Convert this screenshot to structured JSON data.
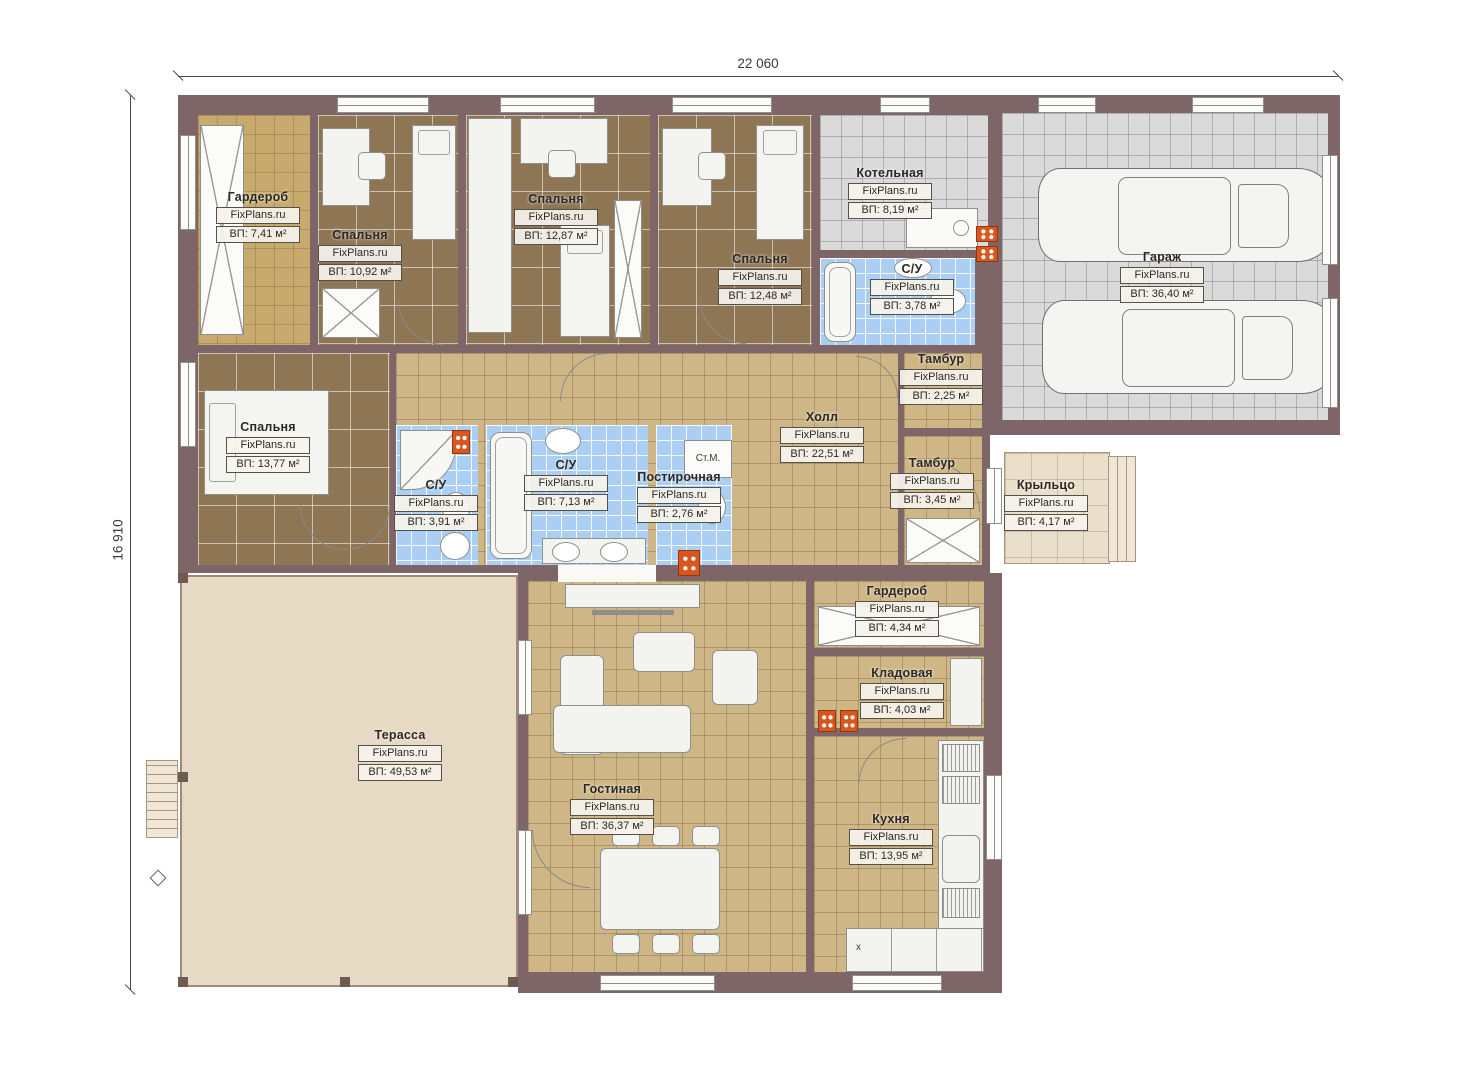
{
  "plan": {
    "width_label": "22 060",
    "height_label": "16 910"
  },
  "watermark": "FixPlans.ru",
  "rooms": [
    {
      "name": "Гардероб",
      "area": "ВП: 7,41 м²"
    },
    {
      "name": "Спальня",
      "area": "ВП: 10,92 м²"
    },
    {
      "name": "Спальня",
      "area": "ВП: 12,87 м²"
    },
    {
      "name": "Спальня",
      "area": "ВП: 12,48 м²"
    },
    {
      "name": "Котельная",
      "area": "ВП: 8,19 м²"
    },
    {
      "name": "Гараж",
      "area": "ВП: 36,40 м²"
    },
    {
      "name": "С/У",
      "area": "ВП: 3,78 м²"
    },
    {
      "name": "Тамбур",
      "area": "ВП: 2,25 м²"
    },
    {
      "name": "Холл",
      "area": "ВП: 22,51 м²"
    },
    {
      "name": "Спальня",
      "area": "ВП: 13,77 м²"
    },
    {
      "name": "С/У",
      "area": "ВП: 3,91 м²"
    },
    {
      "name": "С/У",
      "area": "ВП: 7,13 м²"
    },
    {
      "name": "Постирочная",
      "area": "ВП: 2,76 м²"
    },
    {
      "name": "Тамбур",
      "area": "ВП: 3,45 м²"
    },
    {
      "name": "Крыльцо",
      "area": "ВП: 4,17 м²"
    },
    {
      "name": "Гардероб",
      "area": "ВП: 4,34 м²"
    },
    {
      "name": "Кладовая",
      "area": "ВП: 4,03 м²"
    },
    {
      "name": "Терасса",
      "area": "ВП: 49,53 м²"
    },
    {
      "name": "Гостиная",
      "area": "ВП: 36,37 м²"
    },
    {
      "name": "Кухня",
      "area": "ВП: 13,95 м²"
    }
  ],
  "annotations": {
    "washer_label": "Ст.М.",
    "floor_marker": "x"
  },
  "colors": {
    "wall": "#7d6568",
    "floor_bedroom": "#8e7655",
    "floor_hall": "#cfb687",
    "floor_bath": "#abcff2",
    "floor_garage": "#dadada",
    "floor_terrace": "#e7dac4",
    "radiator": "#d8571f"
  }
}
